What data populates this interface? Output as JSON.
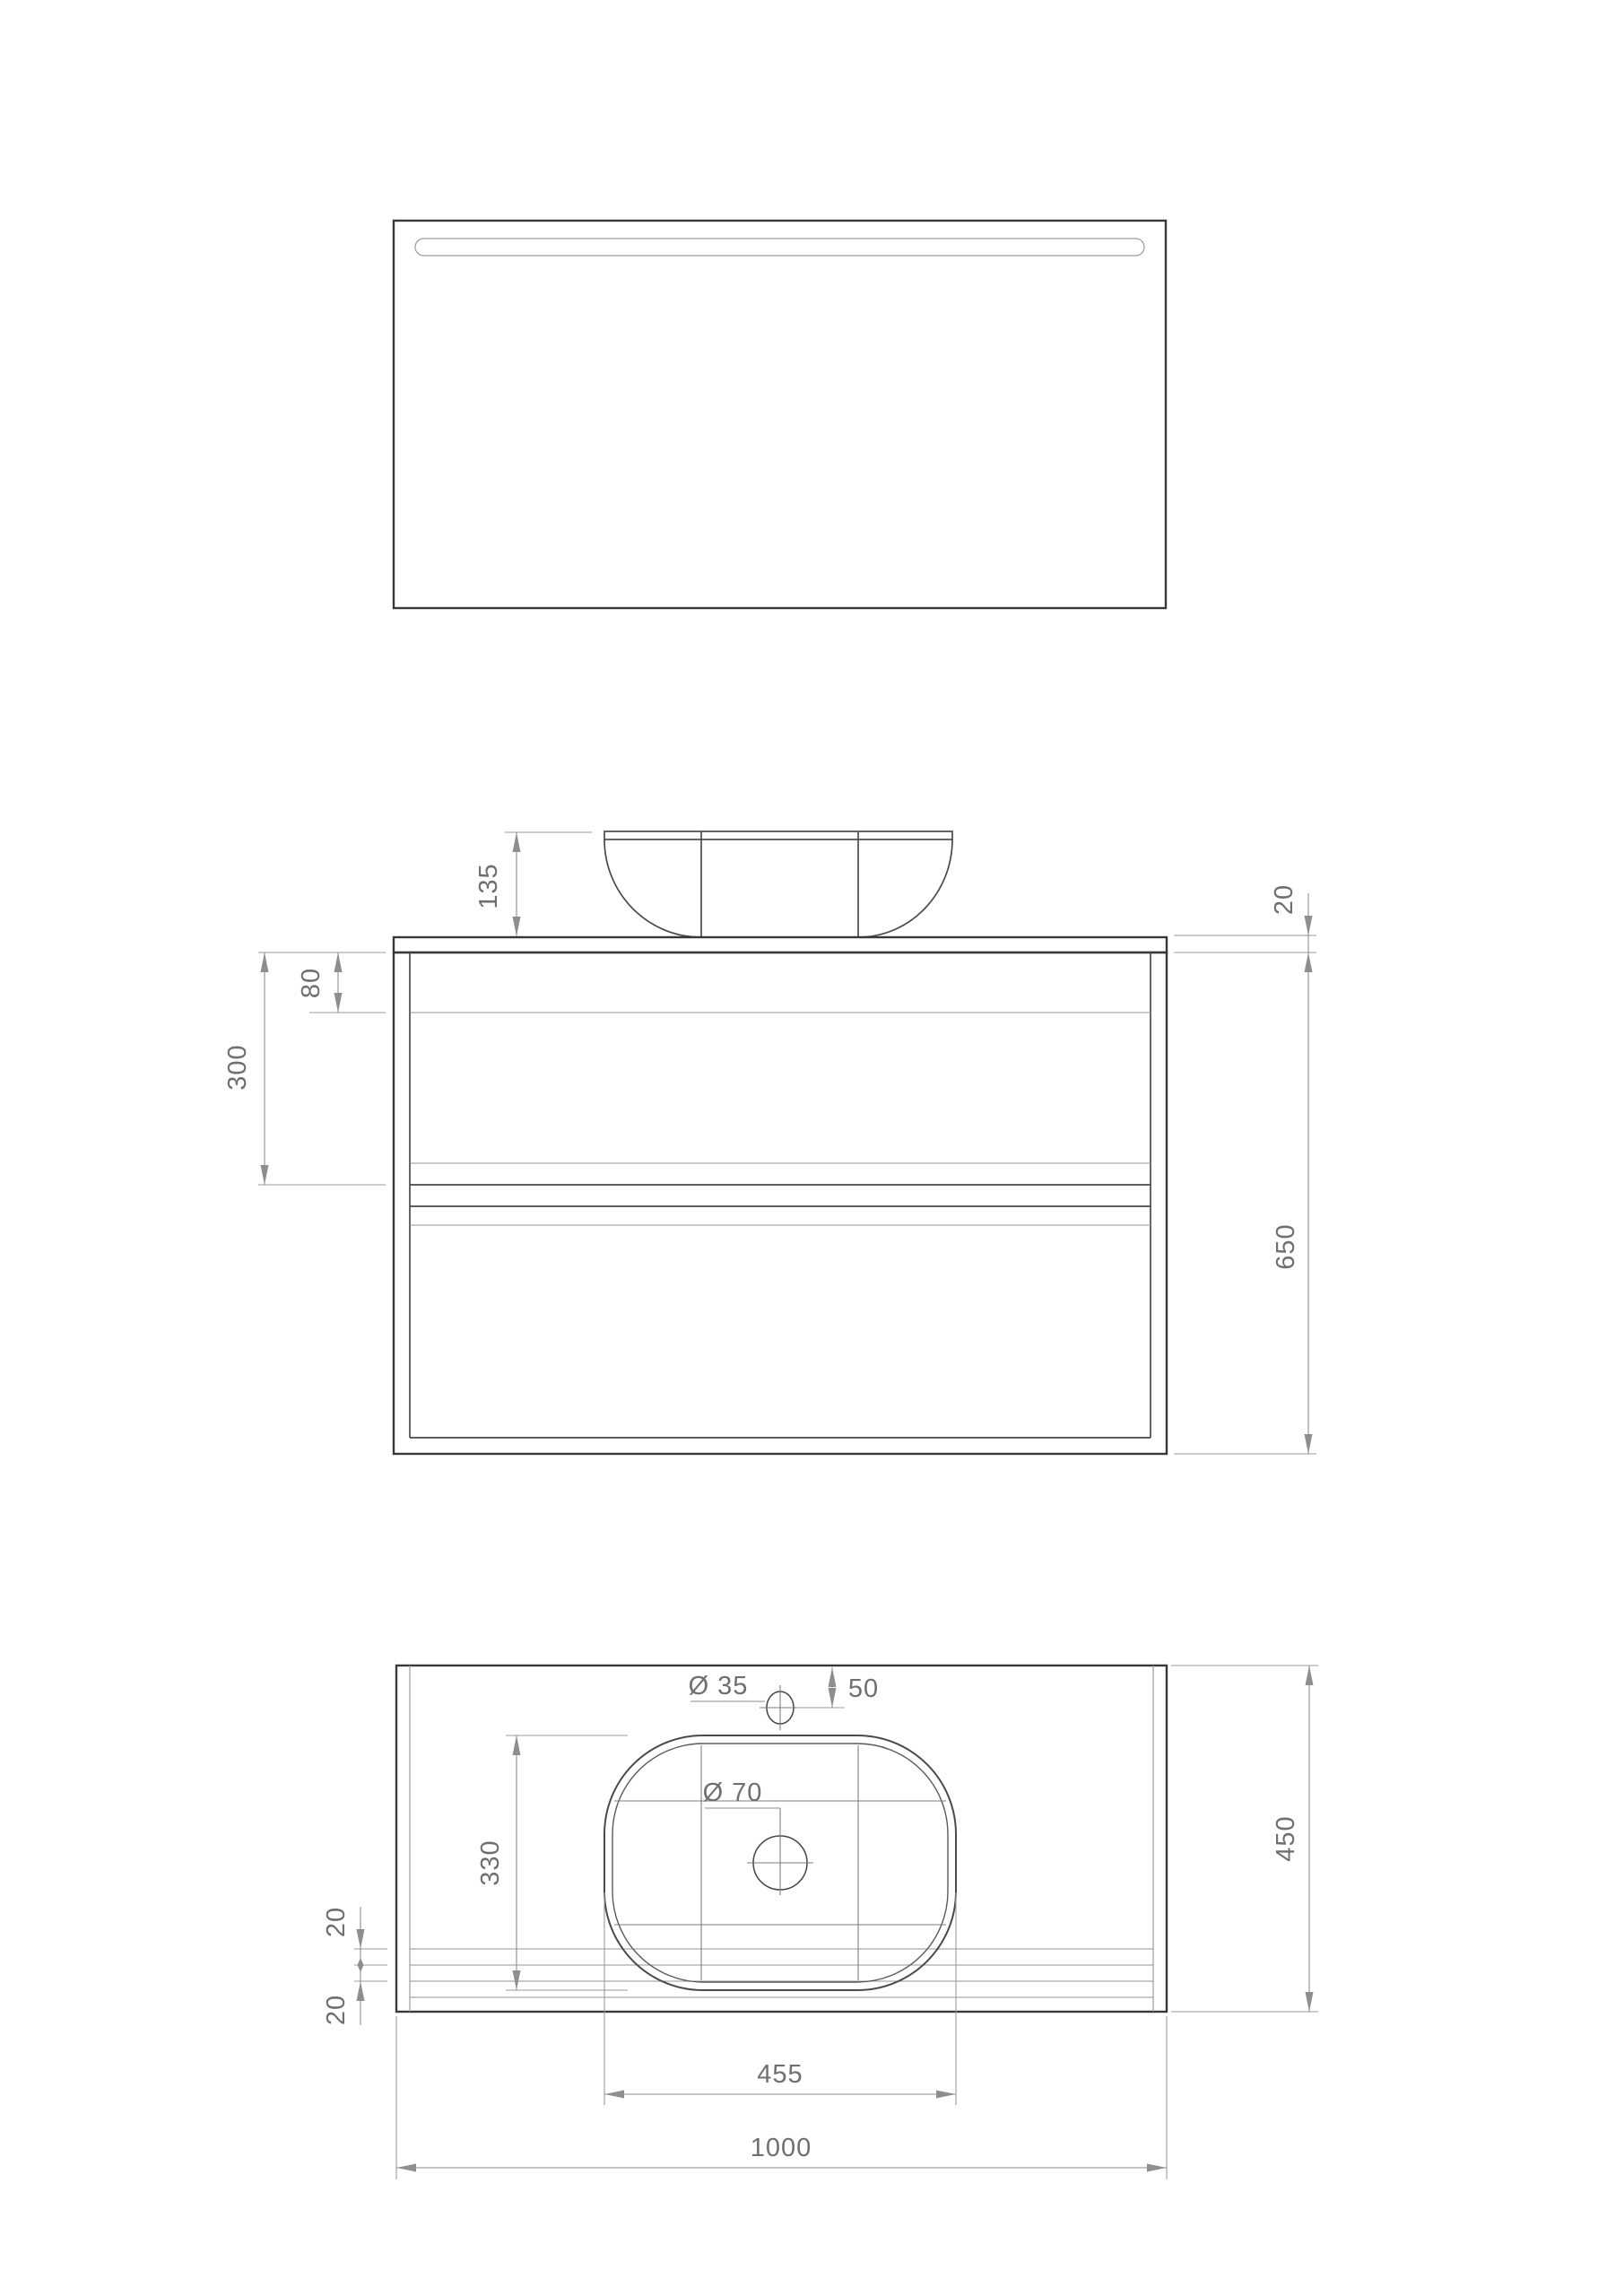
{
  "dims": {
    "basin_height": "135",
    "countertop_thickness": "20",
    "top_drawer_gap": "80",
    "open_compartment_height": "300",
    "cabinet_height": "650",
    "faucet_hole_diameter": "Ø 35",
    "faucet_hole_offset": "50",
    "drain_hole_diameter": "Ø 70",
    "basin_depth": "330",
    "front_edge_gap_a": "20",
    "front_edge_gap_b": "20",
    "basin_width": "455",
    "total_width": "1000",
    "countertop_depth": "450"
  },
  "colors": {
    "background": "#ffffff",
    "outline_dark": "#383838",
    "line_thin": "#949494",
    "dimension_gray": "#8e8e8e",
    "label_text": "#6f6f6f"
  }
}
